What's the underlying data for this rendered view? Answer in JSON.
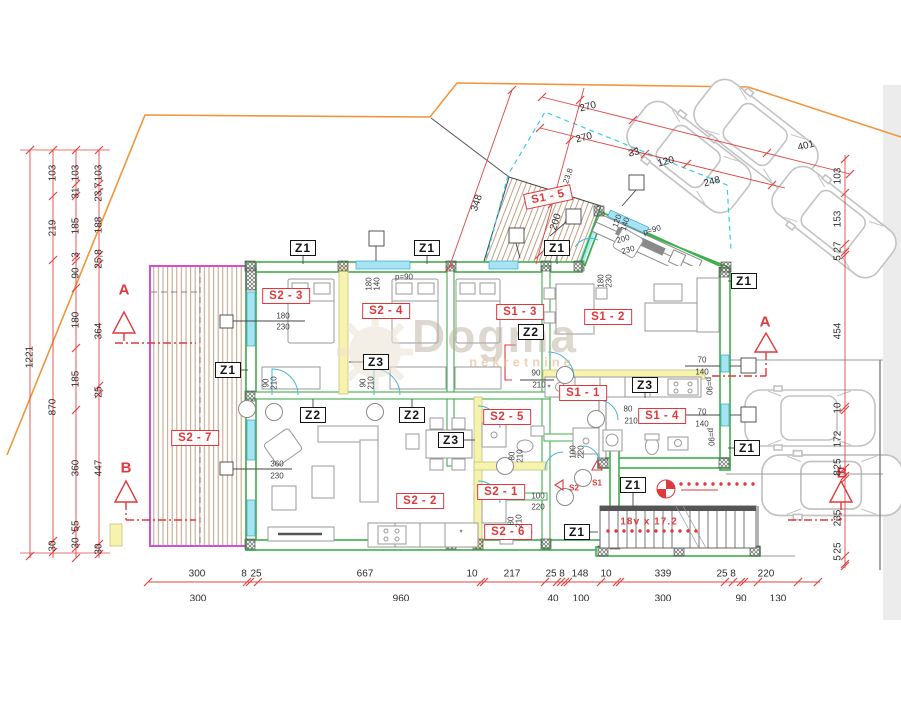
{
  "watermark": {
    "brand": "Dogma",
    "sub": "nekretnine"
  },
  "stairs_label": "18v x 17.2",
  "colors": {
    "wall_green": "#3faf4b",
    "accent_red": "#e0383c",
    "dim_red": "#e04646",
    "window_cyan": "#a6e4f4",
    "partition_yellow": "#f6f3ae",
    "terrace_magenta": "#d44fd4",
    "boundary_orange": "#f0963c",
    "deck_brown": "#c0a183",
    "car_gray": "#c3c3c3"
  },
  "rooms": [
    {
      "label": "S2 - 3",
      "x": 286,
      "y": 296,
      "rot": 0
    },
    {
      "label": "S2 - 4",
      "x": 386,
      "y": 311,
      "rot": 0
    },
    {
      "label": "S1 - 3",
      "x": 520,
      "y": 312,
      "rot": 0
    },
    {
      "label": "S1 - 2",
      "x": 608,
      "y": 317,
      "rot": 0
    },
    {
      "label": "S1 - 5",
      "x": 548,
      "y": 197,
      "rot": -12
    },
    {
      "label": "S2 - 7",
      "x": 195,
      "y": 438,
      "rot": 0
    },
    {
      "label": "S2 - 2",
      "x": 420,
      "y": 501,
      "rot": 0
    },
    {
      "label": "S2 - 5",
      "x": 507,
      "y": 417,
      "rot": 0
    },
    {
      "label": "S1 - 1",
      "x": 583,
      "y": 393,
      "rot": 0
    },
    {
      "label": "S1 - 4",
      "x": 662,
      "y": 416,
      "rot": 0
    },
    {
      "label": "S2 - 1",
      "x": 501,
      "y": 492,
      "rot": 0
    },
    {
      "label": "S2 - 6",
      "x": 508,
      "y": 532,
      "rot": 0
    }
  ],
  "zones": [
    {
      "label": "Z1",
      "x": 303,
      "y": 248
    },
    {
      "label": "Z1",
      "x": 427,
      "y": 248
    },
    {
      "label": "Z1",
      "x": 557,
      "y": 248
    },
    {
      "label": "Z1",
      "x": 228,
      "y": 370
    },
    {
      "label": "Z1",
      "x": 744,
      "y": 281
    },
    {
      "label": "Z1",
      "x": 747,
      "y": 448
    },
    {
      "label": "Z1",
      "x": 633,
      "y": 485
    },
    {
      "label": "Z1",
      "x": 577,
      "y": 532
    },
    {
      "label": "Z2",
      "x": 313,
      "y": 415
    },
    {
      "label": "Z2",
      "x": 412,
      "y": 415
    },
    {
      "label": "Z2",
      "x": 531,
      "y": 332
    },
    {
      "label": "Z3",
      "x": 376,
      "y": 362
    },
    {
      "label": "Z3",
      "x": 451,
      "y": 440
    },
    {
      "label": "Z3",
      "x": 645,
      "y": 385
    }
  ],
  "sections": [
    {
      "letter": "A",
      "x": 124,
      "y": 290
    },
    {
      "letter": "A",
      "x": 765,
      "y": 322
    },
    {
      "letter": "B",
      "x": 126,
      "y": 468
    },
    {
      "letter": "B",
      "x": 842,
      "y": 473
    }
  ],
  "entries": [
    {
      "label": "S1",
      "x": 597,
      "y": 483
    },
    {
      "label": "S2",
      "x": 574,
      "y": 488
    }
  ],
  "dims": [
    {
      "t": "270",
      "x": 588,
      "y": 107,
      "r": -14,
      "c": "lg"
    },
    {
      "t": "270",
      "x": 584,
      "y": 138,
      "r": -14,
      "c": "lg"
    },
    {
      "t": "33",
      "x": 634,
      "y": 153,
      "r": -14,
      "c": "lg"
    },
    {
      "t": "120",
      "x": 666,
      "y": 162,
      "r": -14,
      "c": "lg"
    },
    {
      "t": "401",
      "x": 806,
      "y": 146,
      "r": -14,
      "c": "lg"
    },
    {
      "t": "248",
      "x": 712,
      "y": 182,
      "r": -14,
      "c": "lg"
    },
    {
      "t": "348",
      "x": 477,
      "y": 203,
      "r": -71,
      "c": "lg"
    },
    {
      "t": "23,8",
      "x": 568,
      "y": 176,
      "r": -71,
      "c": "sm"
    },
    {
      "t": "200",
      "x": 556,
      "y": 222,
      "r": -71,
      "c": "lg"
    },
    {
      "t": "1221",
      "x": 30,
      "y": 357,
      "r": -90,
      "c": "lg"
    },
    {
      "t": "103",
      "x": 53,
      "y": 173,
      "r": -90,
      "c": "lg"
    },
    {
      "t": "219",
      "x": 53,
      "y": 228,
      "r": -90,
      "c": "lg"
    },
    {
      "t": "870",
      "x": 53,
      "y": 407,
      "r": -90,
      "c": "lg"
    },
    {
      "t": "30",
      "x": 53,
      "y": 546,
      "r": -90,
      "c": "lg"
    },
    {
      "t": "103",
      "x": 76,
      "y": 173,
      "r": -90,
      "c": "lg"
    },
    {
      "t": "31",
      "x": 76,
      "y": 193,
      "r": -90,
      "c": "lg"
    },
    {
      "t": "185",
      "x": 76,
      "y": 226,
      "r": -90,
      "c": "lg"
    },
    {
      "t": "3",
      "x": 76,
      "y": 255,
      "r": -90,
      "c": "lg"
    },
    {
      "t": "90",
      "x": 76,
      "y": 273,
      "r": -90,
      "c": "lg"
    },
    {
      "t": "180",
      "x": 76,
      "y": 320,
      "r": -90,
      "c": "lg"
    },
    {
      "t": "185",
      "x": 76,
      "y": 379,
      "r": -90,
      "c": "lg"
    },
    {
      "t": "360",
      "x": 76,
      "y": 468,
      "r": -90,
      "c": "lg"
    },
    {
      "t": "55",
      "x": 76,
      "y": 526,
      "r": -90,
      "c": "lg"
    },
    {
      "t": "30",
      "x": 76,
      "y": 543,
      "r": -90,
      "c": "lg"
    },
    {
      "t": "103",
      "x": 99,
      "y": 173,
      "r": -90,
      "c": "lg"
    },
    {
      "t": "23,7",
      "x": 99,
      "y": 192,
      "r": -90,
      "c": "lg"
    },
    {
      "t": "188",
      "x": 99,
      "y": 225,
      "r": -90,
      "c": "lg"
    },
    {
      "t": "25,8",
      "x": 99,
      "y": 259,
      "r": -90,
      "c": "lg"
    },
    {
      "t": "364",
      "x": 99,
      "y": 331,
      "r": -90,
      "c": "lg"
    },
    {
      "t": "25",
      "x": 99,
      "y": 392,
      "r": -90,
      "c": "lg"
    },
    {
      "t": "447",
      "x": 99,
      "y": 468,
      "r": -90,
      "c": "lg"
    },
    {
      "t": "30",
      "x": 99,
      "y": 549,
      "r": -90,
      "c": "lg"
    },
    {
      "t": "103",
      "x": 838,
      "y": 176,
      "r": -90,
      "c": "lg"
    },
    {
      "t": "153",
      "x": 838,
      "y": 219,
      "r": -90,
      "c": "lg"
    },
    {
      "t": "27",
      "x": 838,
      "y": 247,
      "r": -90,
      "c": "lg"
    },
    {
      "t": "5",
      "x": 838,
      "y": 258,
      "r": -90,
      "c": "lg"
    },
    {
      "t": "454",
      "x": 838,
      "y": 331,
      "r": -90,
      "c": "lg"
    },
    {
      "t": "10",
      "x": 838,
      "y": 408,
      "r": -90,
      "c": "lg"
    },
    {
      "t": "172",
      "x": 838,
      "y": 439,
      "r": -90,
      "c": "lg"
    },
    {
      "t": "25",
      "x": 838,
      "y": 464,
      "r": -90,
      "c": "lg"
    },
    {
      "t": "8",
      "x": 838,
      "y": 473,
      "r": -90,
      "c": "lg"
    },
    {
      "t": "235",
      "x": 838,
      "y": 518,
      "r": -90,
      "c": "lg"
    },
    {
      "t": "25",
      "x": 838,
      "y": 548,
      "r": -90,
      "c": "lg"
    },
    {
      "t": "5",
      "x": 838,
      "y": 558,
      "r": -90,
      "c": "lg"
    },
    {
      "t": "300",
      "x": 197,
      "y": 574,
      "r": 0,
      "c": "lg"
    },
    {
      "t": "8",
      "x": 244,
      "y": 574,
      "r": 0,
      "c": "lg"
    },
    {
      "t": "25",
      "x": 256,
      "y": 574,
      "r": 0,
      "c": "lg"
    },
    {
      "t": "667",
      "x": 365,
      "y": 574,
      "r": 0,
      "c": "lg"
    },
    {
      "t": "10",
      "x": 472,
      "y": 574,
      "r": 0,
      "c": "lg"
    },
    {
      "t": "217",
      "x": 512,
      "y": 574,
      "r": 0,
      "c": "lg"
    },
    {
      "t": "25",
      "x": 551,
      "y": 574,
      "r": 0,
      "c": "lg"
    },
    {
      "t": "8",
      "x": 562,
      "y": 574,
      "r": 0,
      "c": "lg"
    },
    {
      "t": "148",
      "x": 580,
      "y": 574,
      "r": 0,
      "c": "lg"
    },
    {
      "t": "10",
      "x": 606,
      "y": 574,
      "r": 0,
      "c": "lg"
    },
    {
      "t": "339",
      "x": 663,
      "y": 574,
      "r": 0,
      "c": "lg"
    },
    {
      "t": "25",
      "x": 722,
      "y": 574,
      "r": 0,
      "c": "lg"
    },
    {
      "t": "8",
      "x": 733,
      "y": 574,
      "r": 0,
      "c": "lg"
    },
    {
      "t": "220",
      "x": 766,
      "y": 574,
      "r": 0,
      "c": "lg"
    },
    {
      "t": "300",
      "x": 198,
      "y": 599,
      "r": 0,
      "c": "lg"
    },
    {
      "t": "960",
      "x": 401,
      "y": 599,
      "r": 0,
      "c": "lg"
    },
    {
      "t": "40",
      "x": 553,
      "y": 599,
      "r": 0,
      "c": "lg"
    },
    {
      "t": "100",
      "x": 581,
      "y": 599,
      "r": 0,
      "c": "lg"
    },
    {
      "t": "300",
      "x": 663,
      "y": 599,
      "r": 0,
      "c": "lg"
    },
    {
      "t": "90",
      "x": 741,
      "y": 599,
      "r": 0,
      "c": "lg"
    },
    {
      "t": "130",
      "x": 778,
      "y": 599,
      "r": 0,
      "c": "lg"
    },
    {
      "t": "120",
      "x": 617,
      "y": 221,
      "r": -71,
      "c": "sm"
    },
    {
      "t": "140",
      "x": 625,
      "y": 224,
      "r": -71,
      "c": "sm"
    },
    {
      "t": "200",
      "x": 623,
      "y": 239,
      "r": -16,
      "c": "sm"
    },
    {
      "t": "230",
      "x": 628,
      "y": 250,
      "r": -16,
      "c": "sm"
    },
    {
      "t": "p=90",
      "x": 652,
      "y": 230,
      "r": -16,
      "c": "sm"
    },
    {
      "t": "180",
      "x": 369,
      "y": 284,
      "r": -90,
      "c": "sm"
    },
    {
      "t": "140",
      "x": 377,
      "y": 284,
      "r": -90,
      "c": "sm"
    },
    {
      "t": "p=90",
      "x": 404,
      "y": 277,
      "r": 0,
      "c": "sm"
    },
    {
      "t": "180",
      "x": 601,
      "y": 281,
      "r": -90,
      "c": "sm"
    },
    {
      "t": "230",
      "x": 609,
      "y": 281,
      "r": -90,
      "c": "sm"
    },
    {
      "t": "180",
      "x": 283,
      "y": 316,
      "r": 0,
      "c": "sm"
    },
    {
      "t": "230",
      "x": 283,
      "y": 327,
      "r": 0,
      "c": "sm"
    },
    {
      "t": "90",
      "x": 266,
      "y": 383,
      "r": -90,
      "c": "sm"
    },
    {
      "t": "210",
      "x": 274,
      "y": 383,
      "r": -90,
      "c": "sm"
    },
    {
      "t": "90",
      "x": 363,
      "y": 383,
      "r": -90,
      "c": "sm"
    },
    {
      "t": "210",
      "x": 371,
      "y": 383,
      "r": -90,
      "c": "sm"
    },
    {
      "t": "90",
      "x": 536,
      "y": 373,
      "r": 0,
      "c": "sm"
    },
    {
      "t": "210",
      "x": 539,
      "y": 385,
      "r": 0,
      "c": "sm"
    },
    {
      "t": "80",
      "x": 628,
      "y": 409,
      "r": 0,
      "c": "sm"
    },
    {
      "t": "210",
      "x": 631,
      "y": 421,
      "r": 0,
      "c": "sm"
    },
    {
      "t": "100",
      "x": 573,
      "y": 452,
      "r": -90,
      "c": "sm"
    },
    {
      "t": "220",
      "x": 581,
      "y": 452,
      "r": -90,
      "c": "sm"
    },
    {
      "t": "80",
      "x": 512,
      "y": 456,
      "r": -90,
      "c": "sm"
    },
    {
      "t": "210",
      "x": 520,
      "y": 456,
      "r": -90,
      "c": "sm"
    },
    {
      "t": "80",
      "x": 511,
      "y": 521,
      "r": -90,
      "c": "sm"
    },
    {
      "t": "210",
      "x": 519,
      "y": 521,
      "r": -90,
      "c": "sm"
    },
    {
      "t": "70",
      "x": 702,
      "y": 360,
      "r": 0,
      "c": "sm"
    },
    {
      "t": "140",
      "x": 702,
      "y": 372,
      "r": 0,
      "c": "sm"
    },
    {
      "t": "p=90",
      "x": 709,
      "y": 386,
      "r": 90,
      "c": "sm"
    },
    {
      "t": "70",
      "x": 702,
      "y": 412,
      "r": 0,
      "c": "sm"
    },
    {
      "t": "140",
      "x": 702,
      "y": 424,
      "r": 0,
      "c": "sm"
    },
    {
      "t": "p=90",
      "x": 711,
      "y": 437,
      "r": 90,
      "c": "sm"
    },
    {
      "t": "360",
      "x": 277,
      "y": 464,
      "r": 0,
      "c": "sm"
    },
    {
      "t": "230",
      "x": 277,
      "y": 476,
      "r": 0,
      "c": "sm"
    },
    {
      "t": "100",
      "x": 538,
      "y": 496,
      "r": 0,
      "c": "sm"
    },
    {
      "t": "220",
      "x": 538,
      "y": 507,
      "r": 0,
      "c": "sm"
    },
    {
      "t": "*",
      "x": 549,
      "y": 388,
      "r": 0,
      "c": "sm"
    },
    {
      "t": "*",
      "x": 461,
      "y": 533,
      "r": 0,
      "c": "sm"
    }
  ]
}
